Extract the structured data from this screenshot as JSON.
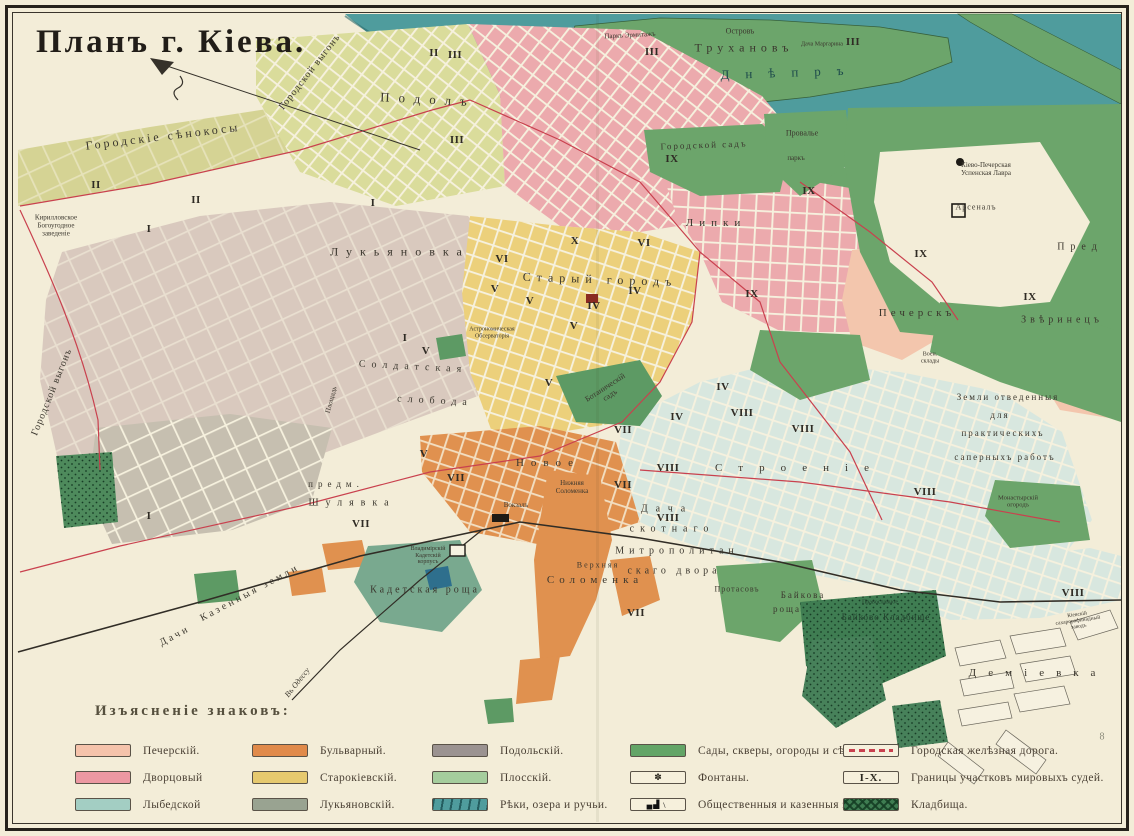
{
  "title": "Планъ г. Кіева.",
  "pencil_mark": "8",
  "legend": {
    "heading": "Изъясненіе знаковъ:",
    "column_offsets": [
      75,
      252,
      432,
      630,
      843
    ],
    "columns": [
      {
        "items": [
          {
            "label": "Печерскій.",
            "swatch": "fill",
            "color": "#f5c3ab"
          },
          {
            "label": "Дворцовый",
            "swatch": "fill",
            "color": "#ec98a2"
          },
          {
            "label": "Лыбедской",
            "swatch": "fill",
            "color": "#a3cec3"
          }
        ]
      },
      {
        "items": [
          {
            "label": "Бульварный.",
            "swatch": "fill",
            "color": "#e08a4a"
          },
          {
            "label": "Старокіевскій.",
            "swatch": "fill",
            "color": "#e6c96e"
          },
          {
            "label": "Лукьяновскій.",
            "swatch": "fill",
            "color": "#99a391"
          }
        ]
      },
      {
        "items": [
          {
            "label": "Подольскій.",
            "swatch": "fill",
            "color": "#9b9391"
          },
          {
            "label": "Плосскій.",
            "swatch": "fill",
            "color": "#a5cd9d"
          },
          {
            "label": "Рѣки, озера и ручьи.",
            "swatch": "water",
            "color": "#4f9c9d"
          }
        ]
      },
      {
        "items": [
          {
            "label": "Сады, скверы, огороды и сѣнок.",
            "swatch": "fill",
            "color": "#63a567"
          },
          {
            "label": "Фонтаны.",
            "swatch": "fountain",
            "icon": "fountain-icon"
          },
          {
            "label": "Общественныя и казенныя зданія.",
            "swatch": "buildings",
            "icon": "buildings-icon"
          }
        ]
      },
      {
        "items": [
          {
            "label": "Городская желѣзная дорога.",
            "swatch": "rail",
            "color": "#c9414e"
          },
          {
            "label": "Границы участковъ мировыхъ судей.",
            "swatch": "ixbox",
            "text": "I-X."
          },
          {
            "label": "Кладбища.",
            "swatch": "hatch",
            "color": "#3f7d52"
          }
        ]
      }
    ]
  },
  "map": {
    "river_label": "Днѣпръ",
    "labels": [
      {
        "t": "Городскіе сѣнокосы",
        "x": 163,
        "y": 137,
        "s": 12,
        "ls": 3,
        "r": -7
      },
      {
        "t": "Городской выгонъ",
        "x": 310,
        "y": 72,
        "s": 10,
        "ls": 1,
        "r": -52
      },
      {
        "t": "Городской выгонъ",
        "x": 52,
        "y": 392,
        "s": 10,
        "ls": 1,
        "r": -68
      },
      {
        "t": "Кирилловское\nБогоугодное\nзаведеніе",
        "x": 56,
        "y": 226,
        "s": 7
      },
      {
        "t": "Подолъ",
        "x": 428,
        "y": 100,
        "s": 13,
        "ls": 9,
        "r": 3
      },
      {
        "t": "Паркъ Эрмитажъ",
        "x": 630,
        "y": 36,
        "s": 7,
        "r": -3
      },
      {
        "t": "Островъ",
        "x": 740,
        "y": 32,
        "s": 8
      },
      {
        "t": "Трухановъ",
        "x": 744,
        "y": 48,
        "s": 12,
        "ls": 5
      },
      {
        "t": "Дача Маргарина",
        "x": 822,
        "y": 45,
        "s": 6
      },
      {
        "t": "Днѣпръ",
        "x": 790,
        "y": 73,
        "s": 13,
        "ls": 16,
        "r": -2,
        "c": "#1d4a4b"
      },
      {
        "t": "Лукьяновка",
        "x": 400,
        "y": 252,
        "s": 12,
        "ls": 8
      },
      {
        "t": "Старый городъ",
        "x": 600,
        "y": 280,
        "s": 12,
        "ls": 6,
        "r": 2
      },
      {
        "t": "Астрономическая\nОбсерваторія",
        "x": 492,
        "y": 333,
        "s": 6
      },
      {
        "t": "Солдатская",
        "x": 413,
        "y": 367,
        "s": 10,
        "ls": 6,
        "r": 3
      },
      {
        "t": "слобода",
        "x": 435,
        "y": 401,
        "s": 10,
        "ls": 6,
        "r": 3
      },
      {
        "t": "Площадь",
        "x": 332,
        "y": 400,
        "s": 7,
        "r": -75
      },
      {
        "t": "Городской садъ",
        "x": 704,
        "y": 145,
        "s": 9,
        "ls": 2,
        "r": -2
      },
      {
        "t": "Провалье",
        "x": 802,
        "y": 134,
        "s": 8
      },
      {
        "t": "паркъ",
        "x": 796,
        "y": 159,
        "s": 7
      },
      {
        "t": "Липки",
        "x": 716,
        "y": 223,
        "s": 11,
        "ls": 6
      },
      {
        "t": "Кіево-Печерская\nУспенская Лавра",
        "x": 986,
        "y": 170,
        "s": 7
      },
      {
        "t": "Арсеналъ",
        "x": 976,
        "y": 208,
        "s": 8,
        "ls": 1
      },
      {
        "t": "Печерскъ",
        "x": 917,
        "y": 313,
        "s": 11,
        "ls": 4
      },
      {
        "t": "Звѣринецъ",
        "x": 1062,
        "y": 320,
        "s": 10,
        "ls": 4
      },
      {
        "t": "Пред",
        "x": 1080,
        "y": 247,
        "s": 10,
        "ls": 6
      },
      {
        "t": "Земли отведенныя",
        "x": 1008,
        "y": 397,
        "s": 9,
        "ls": 2
      },
      {
        "t": "для",
        "x": 1000,
        "y": 415,
        "s": 9,
        "ls": 2
      },
      {
        "t": "практическихъ",
        "x": 1003,
        "y": 433,
        "s": 9,
        "ls": 2
      },
      {
        "t": "саперныхъ работъ",
        "x": 1005,
        "y": 457,
        "s": 9,
        "ls": 2
      },
      {
        "t": "Воен.\nсклады",
        "x": 930,
        "y": 358,
        "s": 6
      },
      {
        "t": "Монастырскій\nогородъ",
        "x": 1018,
        "y": 502,
        "s": 6.5
      },
      {
        "t": "Ботаническій\nсадъ",
        "x": 608,
        "y": 392,
        "s": 8,
        "r": -33
      },
      {
        "t": "Новое",
        "x": 548,
        "y": 463,
        "s": 11,
        "ls": 7
      },
      {
        "t": "Строеніе",
        "x": 800,
        "y": 468,
        "s": 11,
        "ls": 16
      },
      {
        "t": "предм.",
        "x": 336,
        "y": 484,
        "s": 9,
        "ls": 5
      },
      {
        "t": "Шулявка",
        "x": 352,
        "y": 503,
        "s": 10,
        "ls": 7
      },
      {
        "t": "Казенныя земли",
        "x": 250,
        "y": 593,
        "s": 10,
        "ls": 3,
        "r": -28
      },
      {
        "t": "Дачи",
        "x": 175,
        "y": 636,
        "s": 10,
        "ls": 3,
        "r": -28
      },
      {
        "t": "Кадетская роща",
        "x": 425,
        "y": 590,
        "s": 10,
        "ls": 3
      },
      {
        "t": "Владимірскій\nКадетскій\nкорпусъ",
        "x": 428,
        "y": 556,
        "s": 6
      },
      {
        "t": "Верхняя",
        "x": 598,
        "y": 566,
        "s": 8,
        "ls": 2
      },
      {
        "t": "Соломенка",
        "x": 595,
        "y": 580,
        "s": 11,
        "ls": 5
      },
      {
        "t": "Нижняя\nСоломенка",
        "x": 572,
        "y": 488,
        "s": 7
      },
      {
        "t": "Вокзалъ",
        "x": 516,
        "y": 506,
        "s": 7
      },
      {
        "t": "Дача",
        "x": 667,
        "y": 509,
        "s": 10,
        "ls": 8
      },
      {
        "t": "скотнаго",
        "x": 672,
        "y": 529,
        "s": 10,
        "ls": 6
      },
      {
        "t": "Митрополитан",
        "x": 677,
        "y": 551,
        "s": 10,
        "ls": 5
      },
      {
        "t": "скаго двора",
        "x": 674,
        "y": 571,
        "s": 10,
        "ls": 4
      },
      {
        "t": "Протасовъ",
        "x": 737,
        "y": 590,
        "s": 8,
        "ls": 1
      },
      {
        "t": "Байкова",
        "x": 803,
        "y": 595,
        "s": 9,
        "ls": 2
      },
      {
        "t": "роща",
        "x": 787,
        "y": 609,
        "s": 9,
        "ls": 2
      },
      {
        "t": "Православное",
        "x": 880,
        "y": 603,
        "s": 6,
        "c": "#23402e"
      },
      {
        "t": "Байково Кладбище",
        "x": 886,
        "y": 617,
        "s": 9,
        "ls": 1,
        "c": "#23402e"
      },
      {
        "t": "Деміевка",
        "x": 1038,
        "y": 673,
        "s": 11,
        "ls": 12
      },
      {
        "t": "Кіевскій\nсахарорафинадный\nзаводъ",
        "x": 1078,
        "y": 621,
        "s": 5.5,
        "r": -8
      },
      {
        "t": "Въ Одессу",
        "x": 298,
        "y": 683,
        "s": 8,
        "r": -52,
        "i": true
      },
      {
        "t": "8",
        "x": 1102,
        "y": 737,
        "s": 10,
        "c": "#8a8a7a"
      }
    ],
    "district_numerals": [
      {
        "n": "II",
        "x": 96,
        "y": 185
      },
      {
        "n": "I",
        "x": 149,
        "y": 229
      },
      {
        "n": "II",
        "x": 196,
        "y": 200
      },
      {
        "n": "I",
        "x": 373,
        "y": 203
      },
      {
        "n": "II",
        "x": 434,
        "y": 53
      },
      {
        "n": "III",
        "x": 455,
        "y": 55
      },
      {
        "n": "III",
        "x": 457,
        "y": 140
      },
      {
        "n": "III",
        "x": 652,
        "y": 52
      },
      {
        "n": "III",
        "x": 853,
        "y": 42
      },
      {
        "n": "I",
        "x": 405,
        "y": 338
      },
      {
        "n": "V",
        "x": 426,
        "y": 351
      },
      {
        "n": "VI",
        "x": 502,
        "y": 259
      },
      {
        "n": "V",
        "x": 495,
        "y": 289
      },
      {
        "n": "V",
        "x": 530,
        "y": 301
      },
      {
        "n": "V",
        "x": 574,
        "y": 326
      },
      {
        "n": "IV",
        "x": 594,
        "y": 306
      },
      {
        "n": "IV",
        "x": 635,
        "y": 291
      },
      {
        "n": "X",
        "x": 575,
        "y": 241
      },
      {
        "n": "VI",
        "x": 644,
        "y": 243
      },
      {
        "n": "IX",
        "x": 672,
        "y": 159
      },
      {
        "n": "IX",
        "x": 809,
        "y": 191
      },
      {
        "n": "IX",
        "x": 921,
        "y": 254
      },
      {
        "n": "IX",
        "x": 752,
        "y": 294
      },
      {
        "n": "IX",
        "x": 1030,
        "y": 297
      },
      {
        "n": "V",
        "x": 424,
        "y": 454
      },
      {
        "n": "VII",
        "x": 456,
        "y": 478
      },
      {
        "n": "VII",
        "x": 361,
        "y": 524
      },
      {
        "n": "I",
        "x": 149,
        "y": 516
      },
      {
        "n": "VII",
        "x": 623,
        "y": 485
      },
      {
        "n": "VIII",
        "x": 668,
        "y": 518
      },
      {
        "n": "VII",
        "x": 636,
        "y": 613
      },
      {
        "n": "V",
        "x": 549,
        "y": 383
      },
      {
        "n": "IV",
        "x": 723,
        "y": 387
      },
      {
        "n": "IV",
        "x": 677,
        "y": 417
      },
      {
        "n": "VIII",
        "x": 742,
        "y": 413
      },
      {
        "n": "VIII",
        "x": 803,
        "y": 429
      },
      {
        "n": "VIII",
        "x": 668,
        "y": 468
      },
      {
        "n": "VII",
        "x": 623,
        "y": 430
      },
      {
        "n": "VIII",
        "x": 925,
        "y": 492
      },
      {
        "n": "VIII",
        "x": 1073,
        "y": 593
      }
    ]
  },
  "colors": {
    "paper": "#f3edd8",
    "water": "#4f9c9d",
    "park_green": "#6ca56b",
    "cemetery_green": "#3f7d52",
    "pechersky": "#f5c3ab",
    "dvortsovy": "#ec98a2",
    "lybedskoy_map": "#d8e7df",
    "bulvarny": "#e0914f",
    "starokievsky": "#ecd07b",
    "lukyanovsky_map": "#d9c9be",
    "podolsky_map": "#c6bfb0",
    "plossky_map": "#dadc9b",
    "tram_red": "#c9414e",
    "rail_black": "#312d26"
  }
}
